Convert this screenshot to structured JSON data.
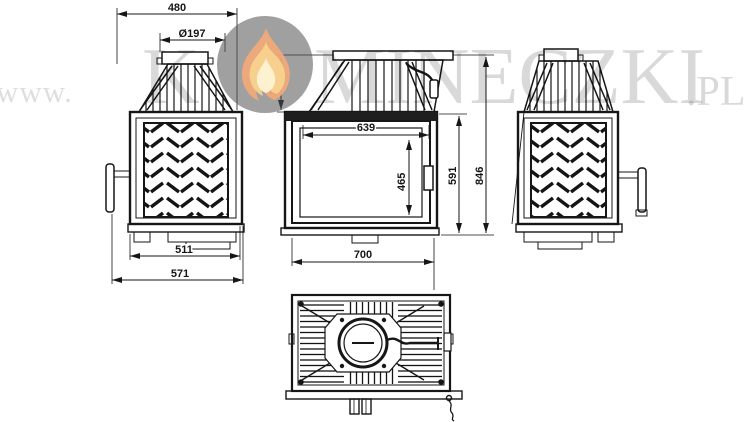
{
  "watermark": {
    "prefix": "www.",
    "brand_first_letter": "K",
    "brand_rest": "MINECZKI",
    "suffix": ".PL",
    "flame_icon": "flame",
    "circle_color": "#8f8f8f",
    "flame_outer_color": "#f2a977",
    "flame_mid_color": "#f8d28f",
    "flame_inner_color": "#fdf3d3"
  },
  "drawing": {
    "line_color": "#161616",
    "views": {
      "side_left": {
        "dims": {
          "top_width": "480",
          "flue_diameter": "Ø197",
          "depth_body": "511",
          "depth_total": "571"
        }
      },
      "front": {
        "dims": {
          "hood_height": "211",
          "glass_width": "639",
          "glass_height": "465",
          "body_height": "591",
          "total_height": "846",
          "total_width": "700"
        }
      }
    }
  }
}
